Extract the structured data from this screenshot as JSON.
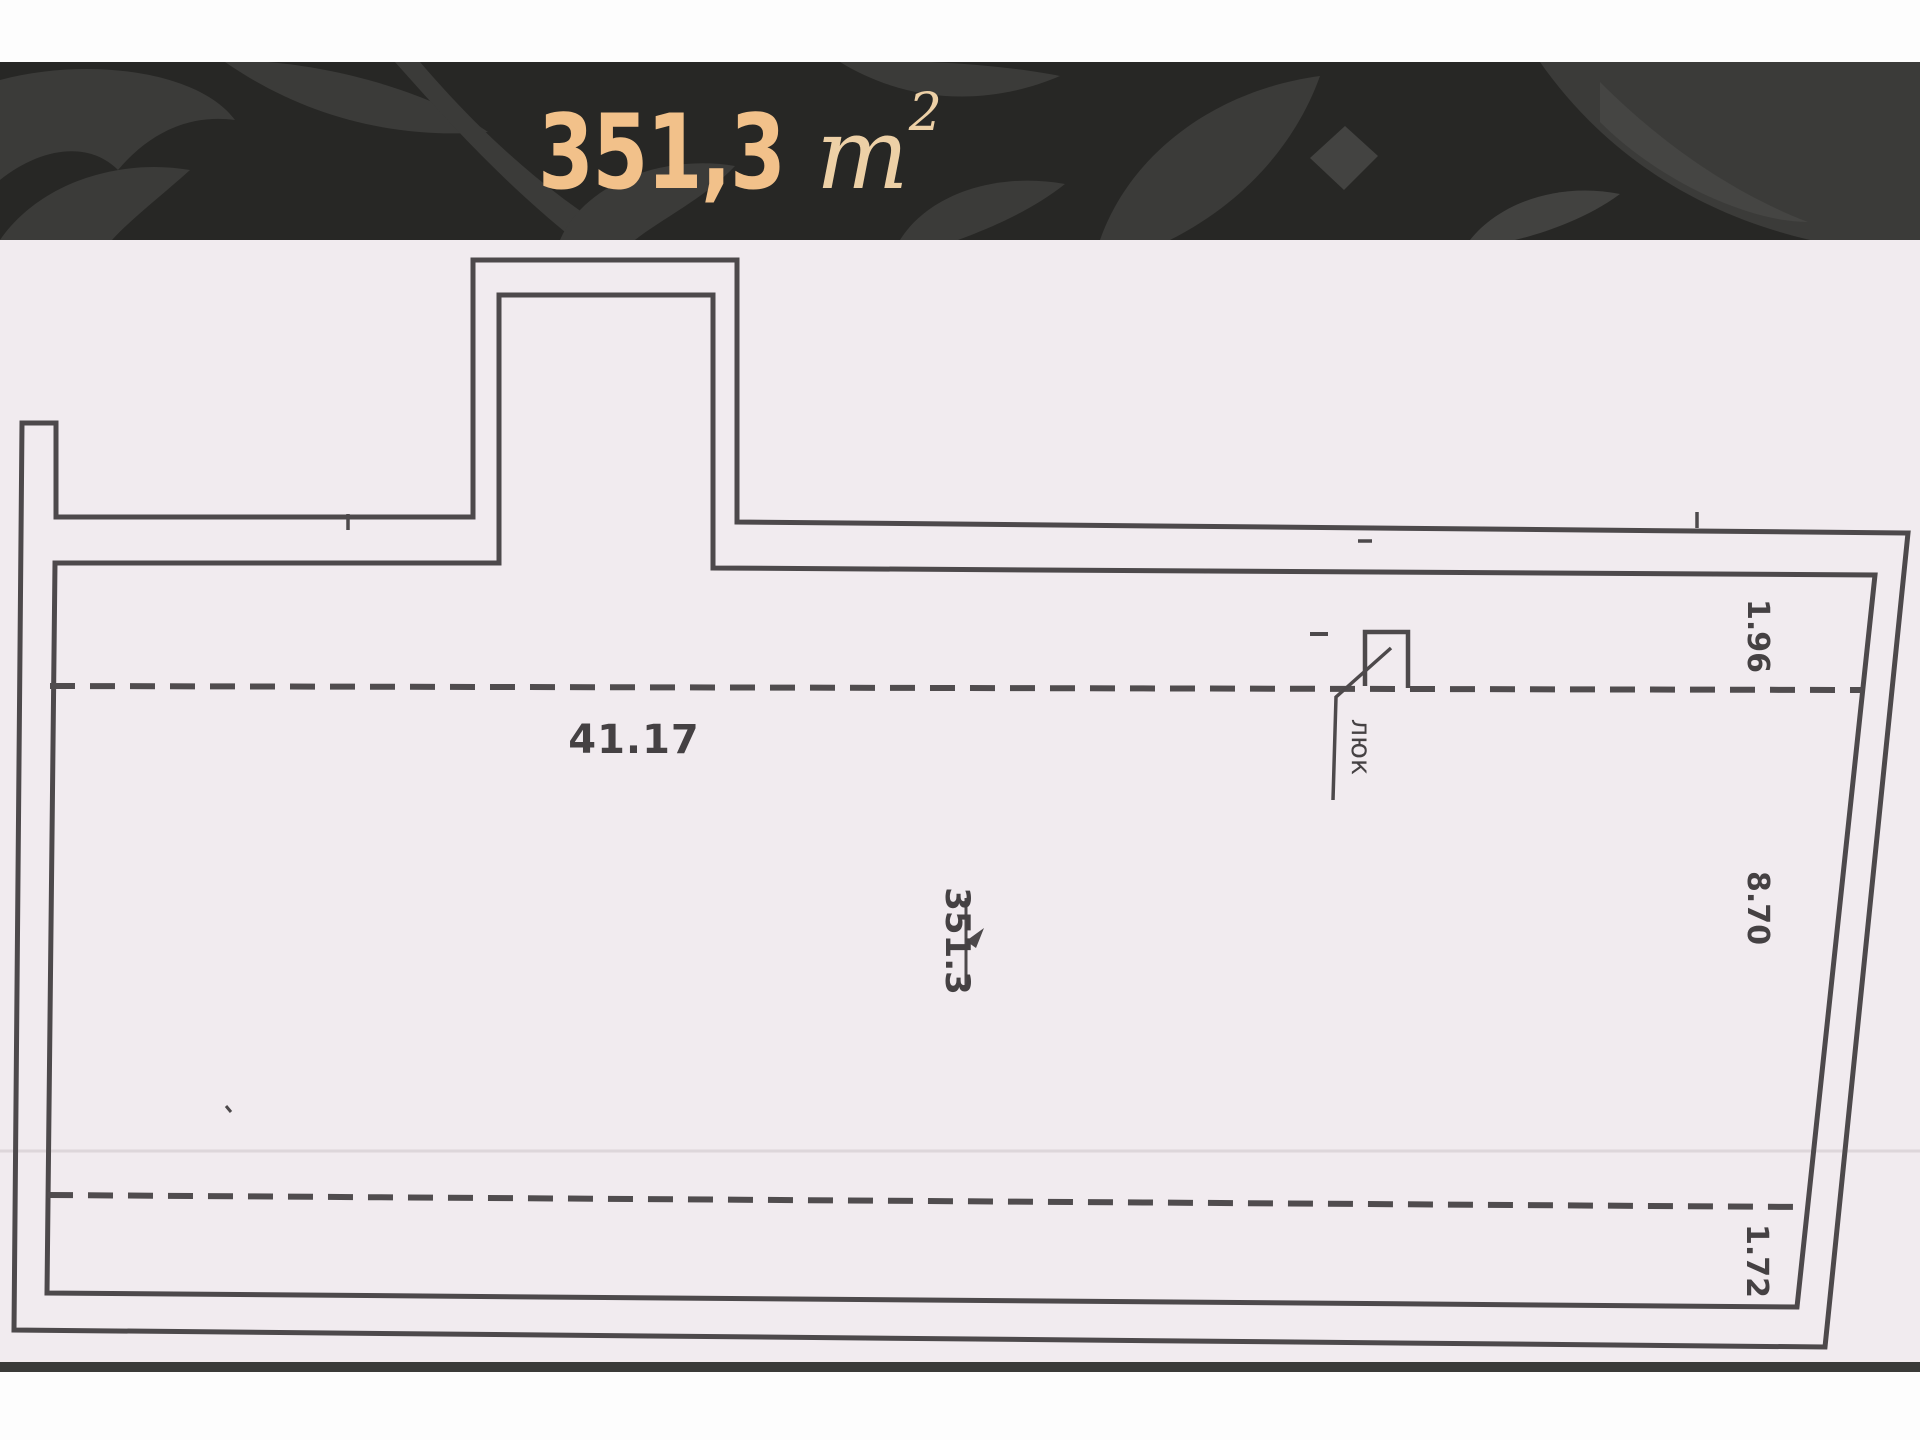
{
  "header": {
    "area_value": "351,3",
    "unit_base": "m",
    "unit_exponent": "2",
    "background": "#272725",
    "ornament_color": "#3b3b39",
    "accent_text_color": "#f2c18a"
  },
  "floor_plan": {
    "dimensions": {
      "top_length": "41.17",
      "right_upper": "1.96",
      "right_middle": "8.70",
      "right_lower": "1.72"
    },
    "area_label": "351.3",
    "hatch_label": "люк",
    "colors": {
      "paper": "#f1ebef",
      "wall_line": "#4d494b",
      "label_text": "#454143",
      "bottom_border": "#3a3a38"
    }
  }
}
